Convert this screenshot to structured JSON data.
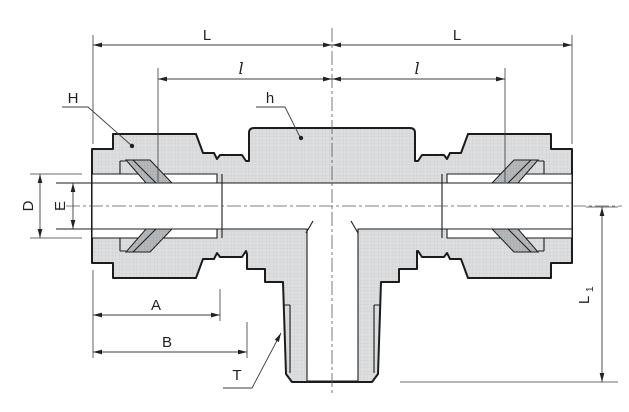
{
  "drawing": {
    "type": "engineering-cross-section",
    "subject": "compression-tube-fitting-branch-tee",
    "labels": {
      "L_left": "L",
      "L_right": "L",
      "l_left": "l",
      "l_right": "l",
      "H": "H",
      "h": "h",
      "D": "D",
      "E": "E",
      "A": "A",
      "B": "B",
      "T": "T",
      "L1_main": "L",
      "L1_sub": "1"
    },
    "colors": {
      "outline": "#1c1c1c",
      "section_fill": "#dcdee0",
      "ferrule_fill": "#b6b9bb",
      "dimension_line": "#3c3c3c",
      "background": "#ffffff"
    }
  }
}
